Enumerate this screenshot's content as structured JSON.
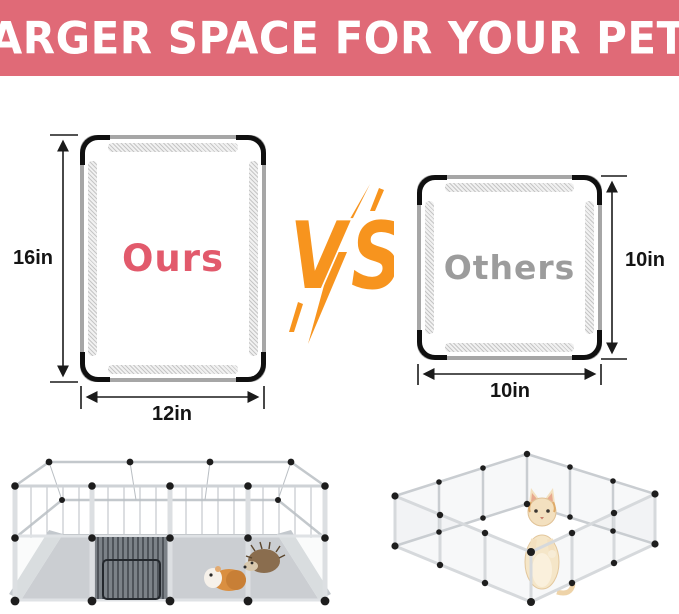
{
  "header": {
    "title": "LARGER SPACE FOR YOUR PETS",
    "bg_color": "#e06a77",
    "text_color": "#ffffff"
  },
  "comparison": {
    "ours": {
      "label": "Ours",
      "label_color": "#e25a6c",
      "height_label": "16in",
      "width_label": "12in"
    },
    "others": {
      "label": "Others",
      "label_color": "#9c9c9c",
      "height_label": "10in",
      "width_label": "10in"
    },
    "vs": {
      "label": "VS",
      "color": "#f7941e"
    }
  }
}
